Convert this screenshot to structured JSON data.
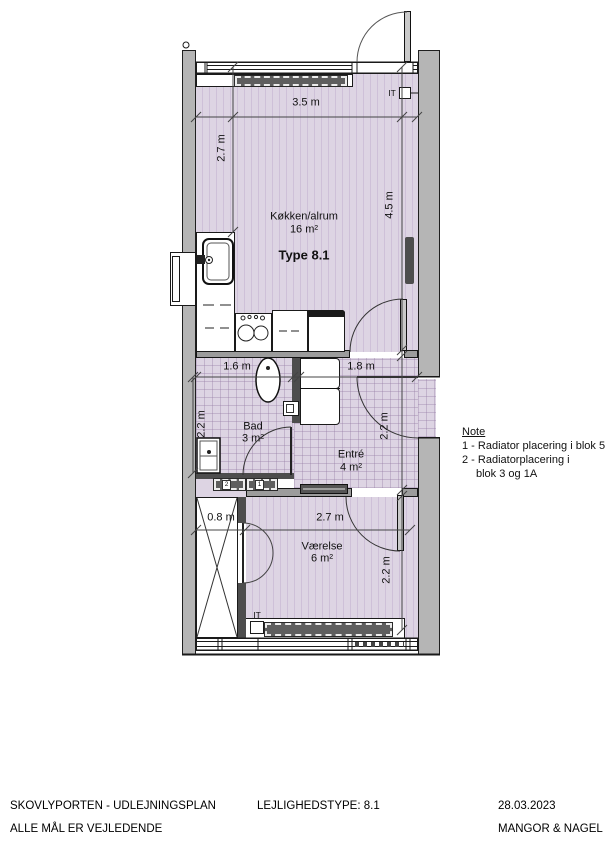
{
  "plan": {
    "rooms": {
      "kitchen": {
        "name": "Køkken/alrum",
        "area": "16 m²",
        "type": "Type 8.1"
      },
      "bad": {
        "name": "Bad",
        "area": "3 m²"
      },
      "entre": {
        "name": "Entré",
        "area": "4 m²"
      },
      "vaerelse": {
        "name": "Værelse",
        "area": "6 m²"
      }
    },
    "dimensions": {
      "kitchen_width": "3.5 m",
      "kitchen_left_height": "2.7 m",
      "kitchen_right_height": "4.5 m",
      "bad_width": "1.6 m",
      "entre_width": "1.8 m",
      "bad_height": "2.2 m",
      "entre_height": "2.2 m",
      "closet_width": "0.8 m",
      "vaerelse_width": "2.7 m",
      "vaerelse_height": "2.2 m"
    },
    "labels": {
      "it_top": "IT",
      "it_bottom": "IT"
    },
    "radiator_tags": {
      "left": "2",
      "right": "1"
    },
    "note": {
      "title": "Note",
      "line1": "1 - Radiator placering i blok 5",
      "line2": "2 - Radiatorplacering i",
      "line3": "blok 3 og 1A"
    }
  },
  "footer": {
    "project": "SKOVLYPORTEN - UDLEJNINGSPLAN",
    "disclaimer": "ALLE MÅL ER VEJLEDENDE",
    "unit_type": "LEJLIGHEDSTYPE: 8.1",
    "date": "28.03.2023",
    "company": "MANGOR & NAGEL"
  },
  "colors": {
    "floor": "#ddd4e3",
    "floor_stripe": "#cec0d8",
    "wall": "#b5b5b5",
    "dark_wall": "#4d4d4d",
    "radiator": "#5e5e5e",
    "line": "#1a1a1a"
  }
}
